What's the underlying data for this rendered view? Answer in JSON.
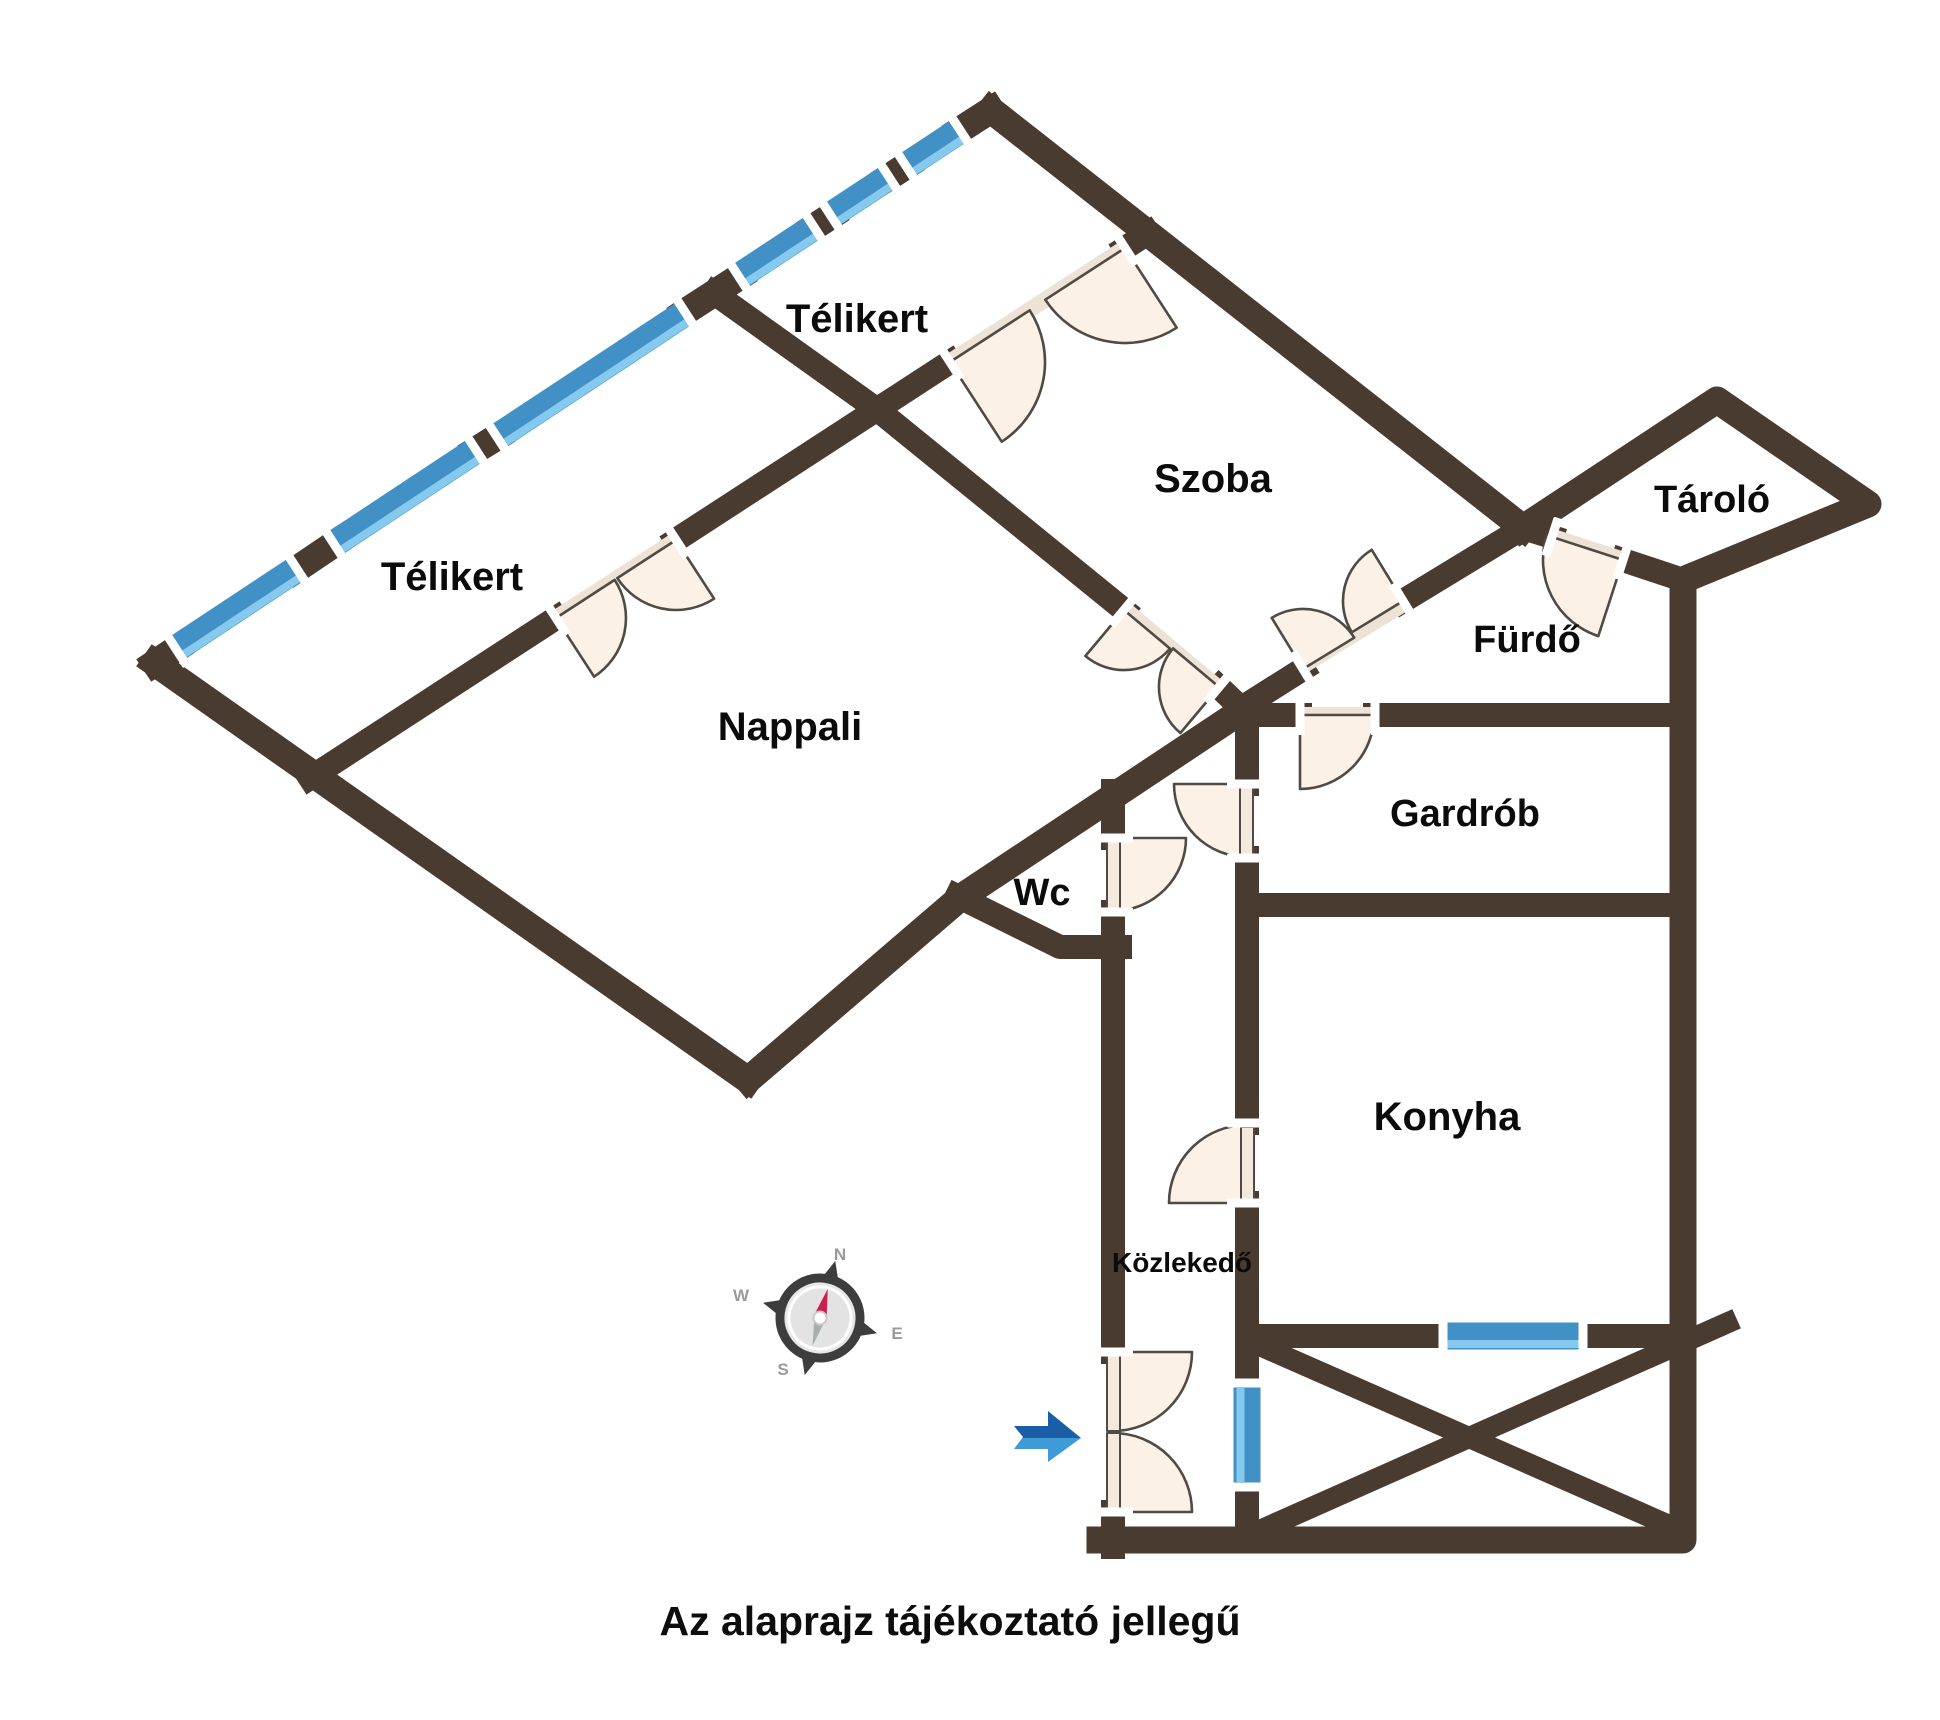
{
  "note": "Az alaprajz tájékoztató jellegű",
  "rooms": [
    {
      "id": "telikert-top",
      "label": "Télikert",
      "x": 857,
      "y": 332,
      "size": 40
    },
    {
      "id": "telikert-left",
      "label": "Télikert",
      "x": 452,
      "y": 590,
      "size": 40
    },
    {
      "id": "szoba",
      "label": "Szoba",
      "x": 1213,
      "y": 492,
      "size": 40
    },
    {
      "id": "nappali",
      "label": "Nappali",
      "x": 790,
      "y": 740,
      "size": 40
    },
    {
      "id": "wc",
      "label": "Wc",
      "x": 1042,
      "y": 905,
      "size": 38
    },
    {
      "id": "furdo",
      "label": "Fürdő",
      "x": 1527,
      "y": 652,
      "size": 38
    },
    {
      "id": "tarolo",
      "label": "Tároló",
      "x": 1712,
      "y": 512,
      "size": 38
    },
    {
      "id": "gardrob",
      "label": "Gardrób",
      "x": 1465,
      "y": 826,
      "size": 38
    },
    {
      "id": "konyha",
      "label": "Konyha",
      "x": 1447,
      "y": 1130,
      "size": 40
    },
    {
      "id": "kozlekedo",
      "label": "Közlekedő",
      "x": 1182,
      "y": 1272,
      "size": 28
    }
  ],
  "compass": {
    "n": "N",
    "e": "E",
    "s": "S",
    "w": "W"
  },
  "colors": {
    "wall": "#4a3b30",
    "window_blue": "#4191c6",
    "window_light": "#85c9ef",
    "door_fill": "#fbf1e6",
    "door_stroke": "#4f4a44",
    "gap_strip": "#ece2d5",
    "leaf_fill": "#f3e9dc",
    "jamb": "#ffffff",
    "arrow_dark": "#1b5ea6",
    "arrow_light": "#3f9ad8",
    "needle_red": "#cb1f4e",
    "needle_tail": "#a9aeae",
    "compass_dark": "#3d3d3d",
    "compass_disk": "#e7e7e7",
    "label": "#0b0b0b"
  }
}
